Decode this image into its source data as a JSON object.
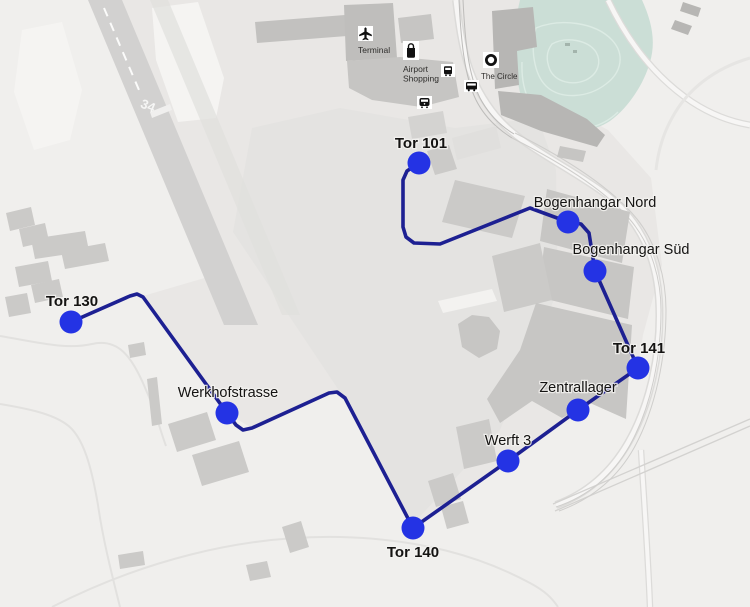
{
  "colors": {
    "route_line": "#1d2092",
    "stop_marker": "#2433e4",
    "park_fill": "#cbded6"
  },
  "runway": {
    "designation": "34"
  },
  "pois": [
    {
      "id": "terminal",
      "icon": "airplane-icon",
      "label": "Terminal"
    },
    {
      "id": "airport-shopping",
      "icon": "shopping-bag-icon",
      "label": "Airport Shopping",
      "label_lines": [
        "Airport",
        "Shopping"
      ]
    },
    {
      "id": "tram-stop",
      "icon": "tram-icon"
    },
    {
      "id": "the-circle",
      "icon": "circle-icon",
      "label": "The Circle"
    },
    {
      "id": "bus-stop",
      "icon": "bus-icon"
    },
    {
      "id": "train-station",
      "icon": "train-icon"
    }
  ],
  "route": {
    "points": [
      [
        419,
        163
      ],
      [
        407,
        171
      ],
      [
        403,
        180
      ],
      [
        403,
        227
      ],
      [
        406,
        237
      ],
      [
        414,
        243
      ],
      [
        440,
        244
      ],
      [
        530,
        208
      ],
      [
        568,
        222
      ],
      [
        581,
        224
      ],
      [
        589,
        233
      ],
      [
        595,
        271
      ],
      [
        638,
        368
      ],
      [
        578,
        410
      ],
      [
        508,
        461
      ],
      [
        413,
        528
      ],
      [
        345,
        398
      ],
      [
        337,
        392
      ],
      [
        329,
        393
      ],
      [
        252,
        428
      ],
      [
        243,
        430
      ],
      [
        236,
        425
      ],
      [
        227,
        413
      ],
      [
        143,
        297
      ],
      [
        137,
        294
      ],
      [
        130,
        296
      ],
      [
        71,
        322
      ]
    ],
    "stops": [
      {
        "name": "Tor 101",
        "x": 419,
        "y": 163,
        "label_x": 421,
        "label_y": 148,
        "emphasis": true
      },
      {
        "name": "Bogenhangar Nord",
        "x": 568,
        "y": 222,
        "label_x": 595,
        "label_y": 207,
        "emphasis": false
      },
      {
        "name": "Bogenhangar Süd",
        "x": 595,
        "y": 271,
        "label_x": 631,
        "label_y": 254,
        "emphasis": false
      },
      {
        "name": "Tor 141",
        "x": 638,
        "y": 368,
        "label_x": 639,
        "label_y": 353,
        "emphasis": true
      },
      {
        "name": "Zentrallager",
        "x": 578,
        "y": 410,
        "label_x": 578,
        "label_y": 392,
        "emphasis": false
      },
      {
        "name": "Werft 3",
        "x": 508,
        "y": 461,
        "label_x": 508,
        "label_y": 445,
        "emphasis": false
      },
      {
        "name": "Tor 140",
        "x": 413,
        "y": 528,
        "label_x": 413,
        "label_y": 557,
        "emphasis": true
      },
      {
        "name": "Werkhofstrasse",
        "x": 227,
        "y": 413,
        "label_x": 228,
        "label_y": 397,
        "emphasis": false
      },
      {
        "name": "Tor 130",
        "x": 71,
        "y": 322,
        "label_x": 72,
        "label_y": 306,
        "emphasis": true
      }
    ]
  }
}
